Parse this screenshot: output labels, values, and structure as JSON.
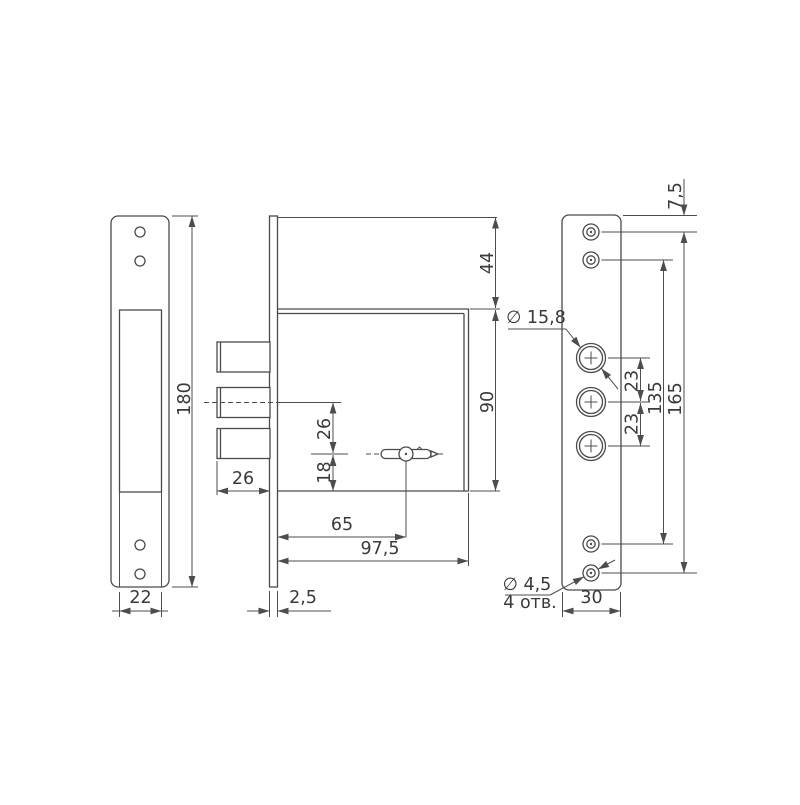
{
  "strike_plate_view": {
    "height": "180",
    "channel_width": "22"
  },
  "lock_body_view": {
    "top_to_body": "44",
    "body_height": "90",
    "bolt_throw": "26",
    "bolt_axis_to_key": "26",
    "key_to_body_bottom": "18",
    "key_backset": "65",
    "body_depth": "97,5",
    "faceplate_thickness": "2,5"
  },
  "faceplate_view": {
    "top_to_first_hole": "7,5",
    "bolt_hole_diameter": "∅ 15,8",
    "bolt_hole_pitch_upper": "23",
    "bolt_hole_pitch_lower": "23",
    "screw_span_135": "135",
    "screw_span_165": "165",
    "screw_hole_diameter": "∅ 4,5",
    "screw_hole_count": "4 отв.",
    "width": "30"
  }
}
